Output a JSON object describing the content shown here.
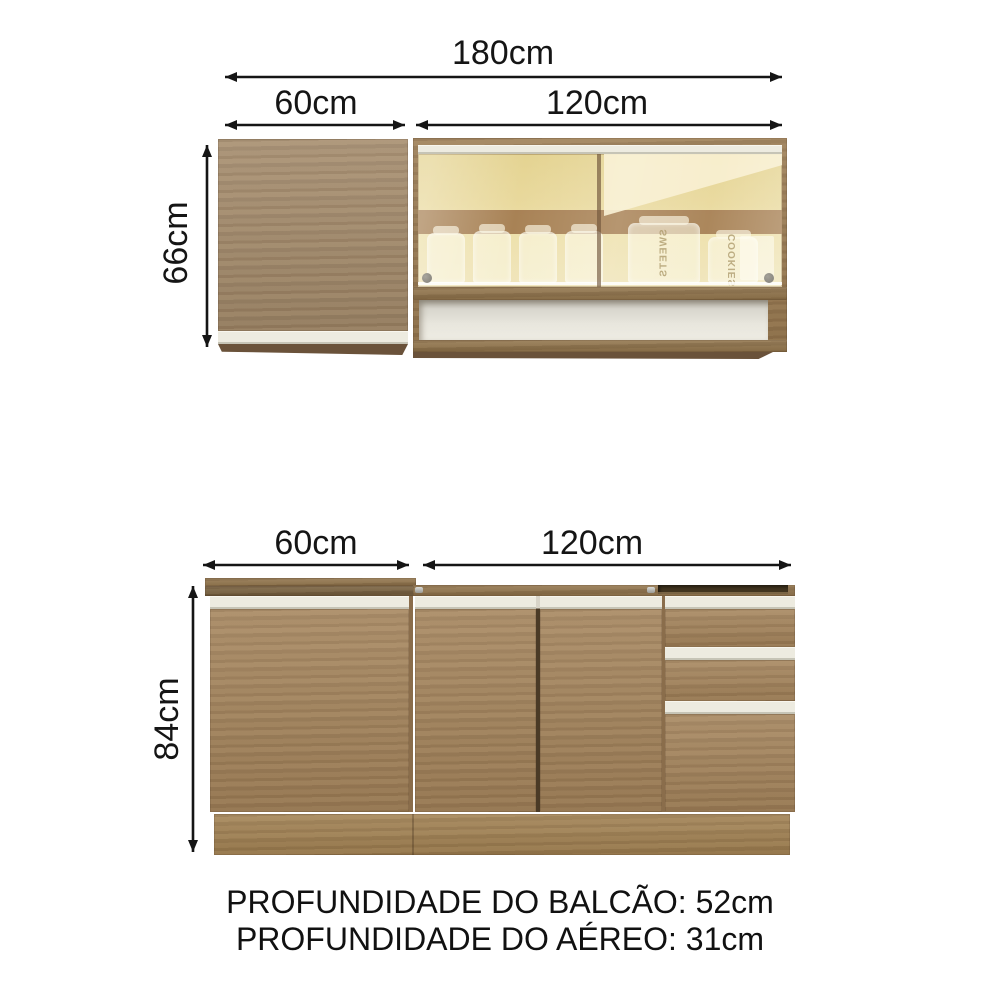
{
  "diagram": {
    "upper_section": {
      "total_width_label": "180cm",
      "left_width_label": "60cm",
      "right_width_label": "120cm",
      "height_label": "66cm"
    },
    "lower_section": {
      "left_width_label": "60cm",
      "right_width_label": "120cm",
      "height_label": "84cm"
    },
    "footer": {
      "balcao_depth": "PROFUNDIDADE DO BALCÃO: 52cm",
      "aereo_depth": "PROFUNDIDADE DO AÉREO: 31cm"
    },
    "glass_cabinet_jars": {
      "jar_label_1": "SWEETS",
      "jar_label_2": "COOKIES"
    },
    "colors": {
      "background": "#ffffff",
      "text": "#151515",
      "wood_base": "#a2825a",
      "wood_upper_door": "#a28a6c",
      "wood_frame": "#97784f",
      "counter_front": "#6f5939",
      "handle_strip": "#edebe0",
      "glass_amber": "#ead98f",
      "interior_band": "#a2794e",
      "niche_interior": "#e3e1d8",
      "toe_kick": "#9f7f50"
    }
  }
}
